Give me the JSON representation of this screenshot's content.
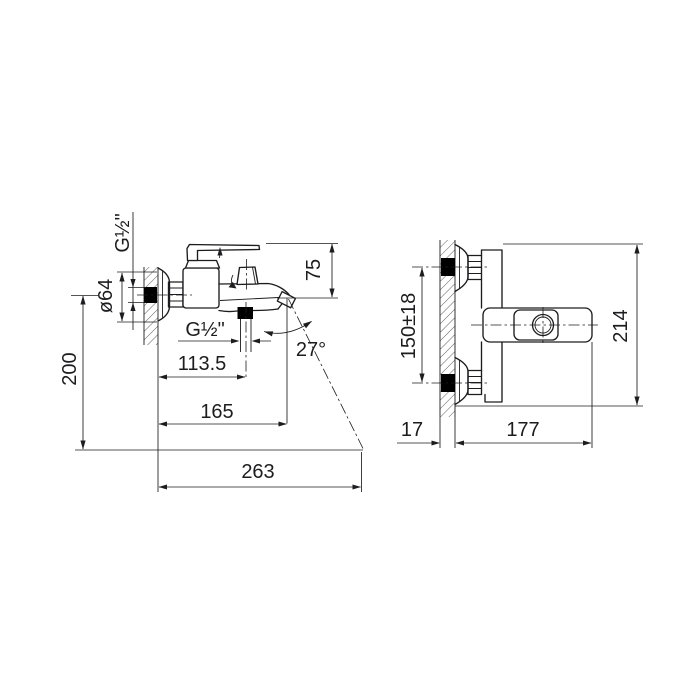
{
  "diagram": {
    "kind": "faucet installation dimension drawing",
    "background_color": "#ffffff",
    "line_color": "#1d1d1f",
    "views": {
      "side": {
        "wall_thread": "G½\"",
        "escutcheon_diameter": "ø64",
        "mount_height": "200",
        "handle_height": "75",
        "shower_outlet_thread": "G½\"",
        "outlet_offset": "113.5",
        "spout_reach": "165",
        "stream_reach": "263",
        "stream_angle": "27°"
      },
      "front": {
        "inlet_spacing": "150±18",
        "overall_height": "214",
        "wall_offset": "17",
        "body_length": "177"
      }
    }
  }
}
